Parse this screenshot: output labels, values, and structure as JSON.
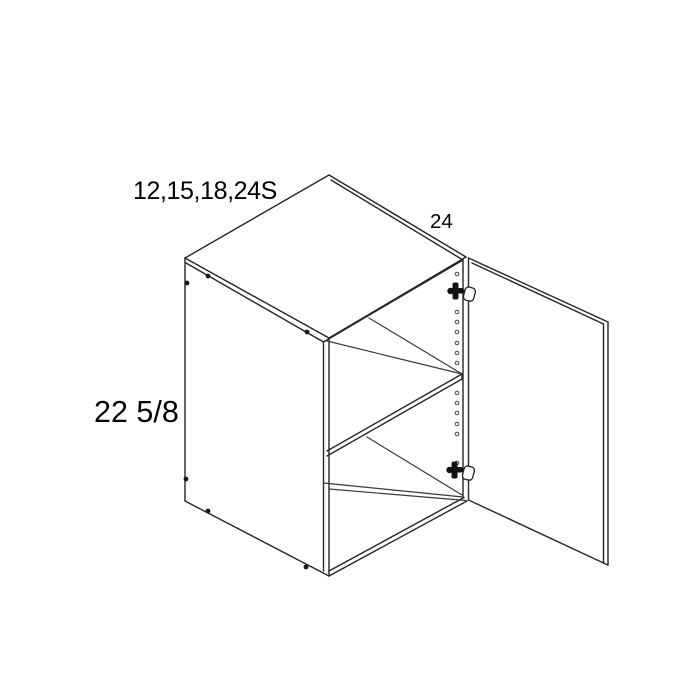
{
  "diagram": {
    "type": "cabinet-isometric-spec-drawing",
    "labels": {
      "width_options": "12,15,18,24S",
      "depth": "24",
      "height": "22 5/8"
    },
    "colors": {
      "background": "#ffffff",
      "line": "#262626",
      "text": "#000000"
    }
  }
}
